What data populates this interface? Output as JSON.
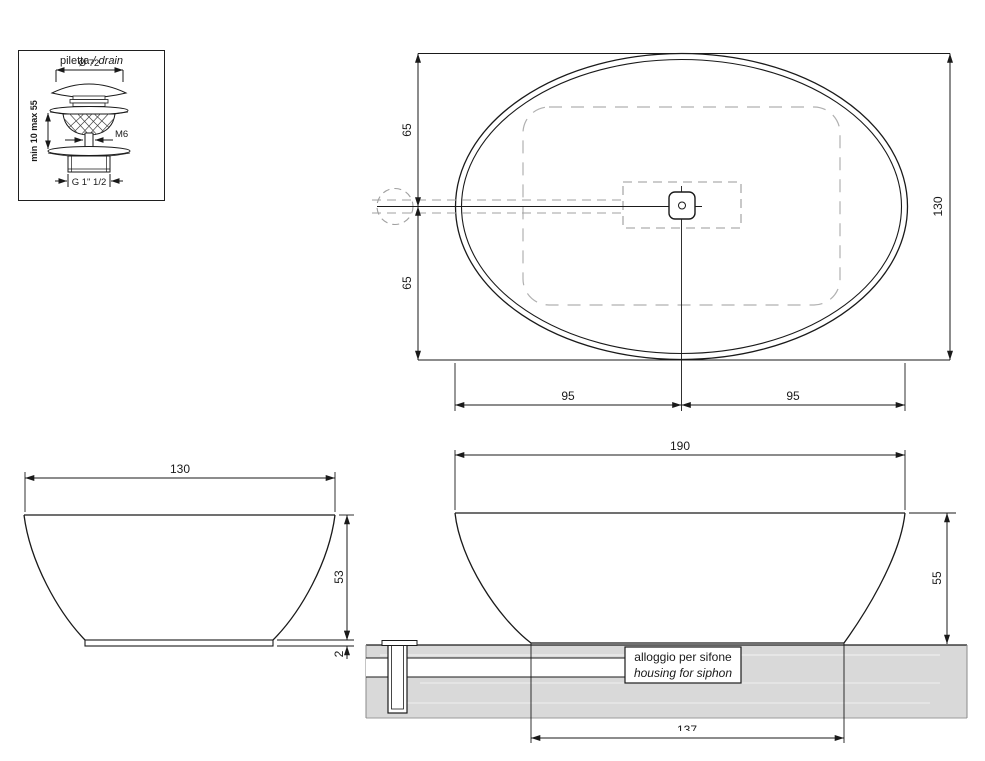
{
  "drawing": {
    "type": "technical-drawing",
    "subject": "oval countertop washbasin with drain detail"
  },
  "colors": {
    "line": "#1a1a1a",
    "hidden_dash": "#9e9e9e",
    "light_dash": "#b0b0b0",
    "countertop_fill": "#d9d9d9"
  },
  "detail_box": {
    "title_regular": "piletta",
    "title_italic": "/ drain",
    "dim_diameter": "Ø 72",
    "dim_clamp": "min 10 max 55",
    "label_thread_top": "M6",
    "label_thread_bottom": "G 1\" 1/2"
  },
  "plan_view": {
    "dim_top_half": "65",
    "dim_bottom_half": "65",
    "dim_total_height": "130",
    "dim_left_half": "95",
    "dim_right_half": "95"
  },
  "side_view": {
    "dim_width": "130",
    "dim_height": "53",
    "dim_base_thickness": "2"
  },
  "section_view": {
    "dim_width": "190",
    "dim_height": "55",
    "dim_base_width": "137",
    "siphon_line1": "alloggio per sifone",
    "siphon_line2": "housing for siphon"
  }
}
